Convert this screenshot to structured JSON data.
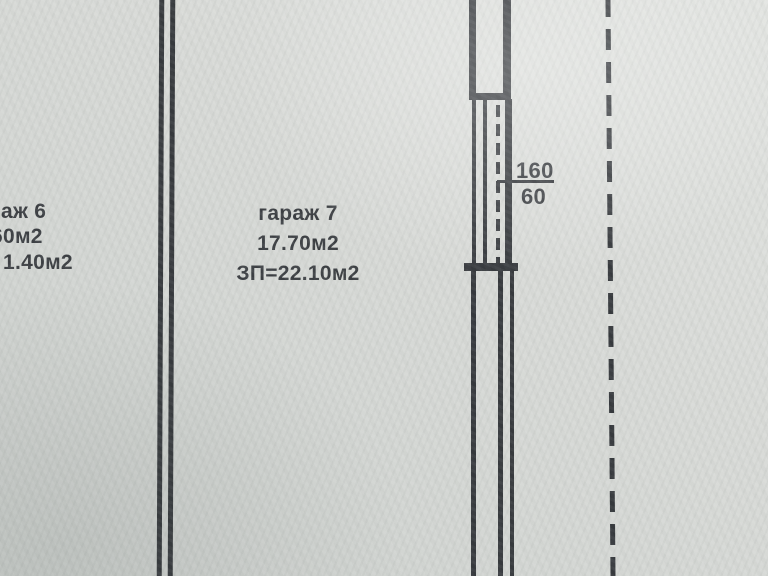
{
  "colors": {
    "paper_light": "#e2e4e1",
    "paper_dark": "#c9cdca",
    "ink": "#35383c",
    "text": "#3a3d41"
  },
  "garage6": {
    "name_fragment": "аж 6",
    "area_fragment": "60м2",
    "total_area_fragment": "1.40м2"
  },
  "garage7": {
    "name": "гараж 7",
    "area": "17.70м2",
    "total_area": "ЗП=22.10м2"
  },
  "window_dimension": {
    "width_value": "160",
    "sill_value": "60"
  }
}
